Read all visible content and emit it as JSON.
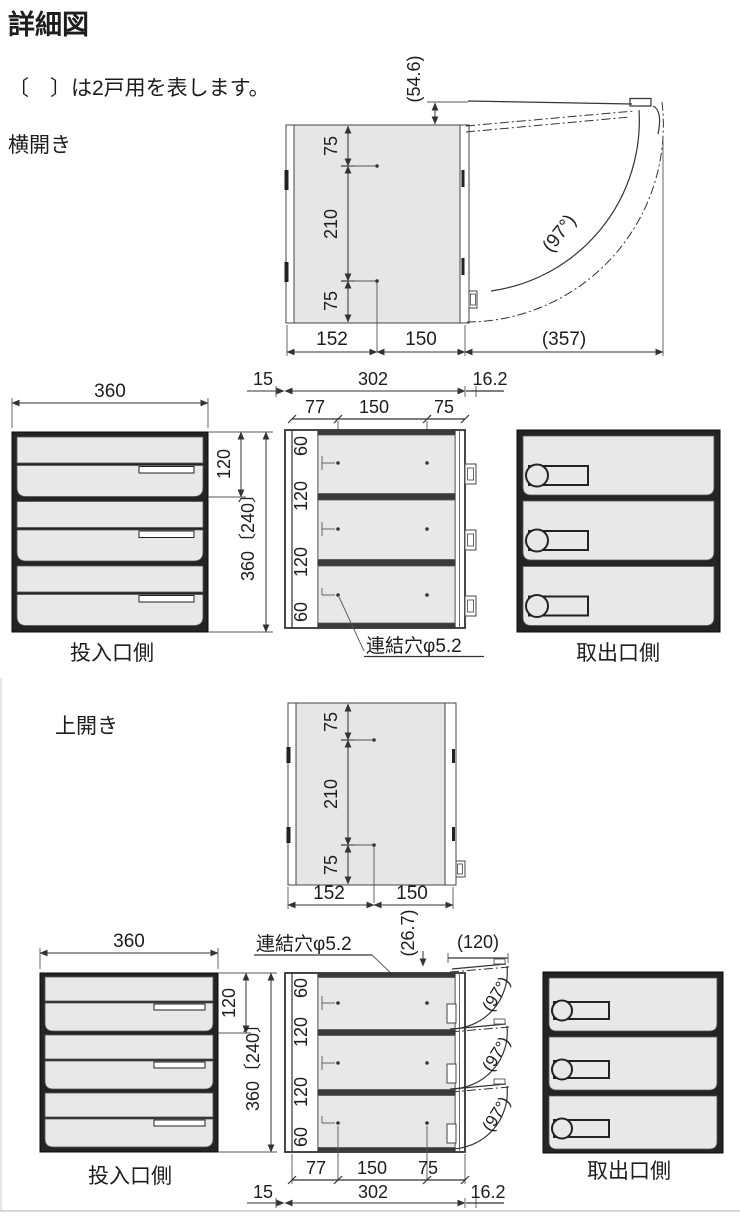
{
  "header": {
    "title": "詳細図",
    "note": "〔　〕は2戸用を表します。"
  },
  "yoko": {
    "label": "横開き",
    "plan": {
      "lid_gap": "(54.6)",
      "top75": "75",
      "mid210": "210",
      "bot75": "75",
      "depth_rear": "152",
      "depth_front": "150",
      "swing_depth": "(357)",
      "swing_angle": "(97°)"
    },
    "front": {
      "width": "360",
      "unit_height": "120",
      "total_height": "360〔240〕",
      "caption": "投入口側"
    },
    "rear": {
      "left": "15",
      "width": "302",
      "right": "16.2",
      "x1": "77",
      "x2": "150",
      "x3": "75",
      "y1": "60",
      "y2": "120",
      "y3": "120",
      "y4": "60",
      "hole_note": "連結穴φ5.2"
    },
    "outlet": {
      "caption": "取出口側"
    }
  },
  "ue": {
    "label": "上開き",
    "plan": {
      "top75": "75",
      "mid210": "210",
      "bot75": "75",
      "depth_rear": "152",
      "depth_front": "150"
    },
    "front": {
      "width": "360",
      "unit_height": "120",
      "total_height": "360〔240〕",
      "caption": "投入口側"
    },
    "rear": {
      "hole_note": "連結穴φ5.2",
      "lid_gap": "(26.7)",
      "lid_open": "(120)",
      "y1": "60",
      "y2": "120",
      "y3": "120",
      "y4": "60",
      "angle": "(97°)",
      "x1": "77",
      "x2": "150",
      "x3": "75",
      "left": "15",
      "width": "302",
      "right": "16.2"
    },
    "outlet": {
      "caption": "取出口側"
    }
  }
}
